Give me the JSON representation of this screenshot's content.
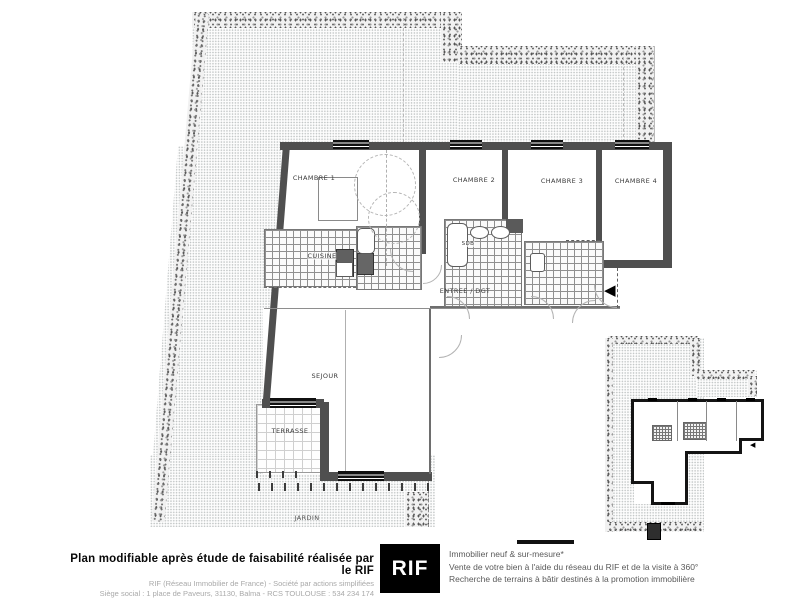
{
  "plan": {
    "labels": {
      "chambre1": "CHAMBRE 1",
      "chambre2": "CHAMBRE 2",
      "chambre3": "CHAMBRE 3",
      "chambre4": "CHAMBRE 4",
      "cuisine": "CUISINE",
      "sdb": "SDB",
      "entree": "ENTREE / DGT",
      "sejour": "SEJOUR",
      "terrasse": "TERRASSE",
      "jardin": "JARDIN"
    },
    "icons": {
      "entrance_arrow": "◀"
    }
  },
  "footer": {
    "disclaimer_title": "Plan modifiable après étude de faisabilité réalisée par le RIF",
    "disclaimer_line2": "RIF (Réseau Immobilier de France) - Société par actions simplifiées",
    "disclaimer_line3": "Siège social : 1 place de Paveurs, 31130, Balma - RCS TOULOUSE : 534 234 174",
    "logo_text": "RIF",
    "services_line1": "Immobilier neuf & sur-mesure*",
    "services_line2": "Vente de votre bien à l'aide du réseau du RIF et de la visite à 360°",
    "services_line3": "Recherche de terrains à bâtir destinés à la promotion immobilière"
  },
  "colors": {
    "wall": "#4f4f4f",
    "logo_bg": "#000000",
    "logo_text": "#ffffff"
  }
}
